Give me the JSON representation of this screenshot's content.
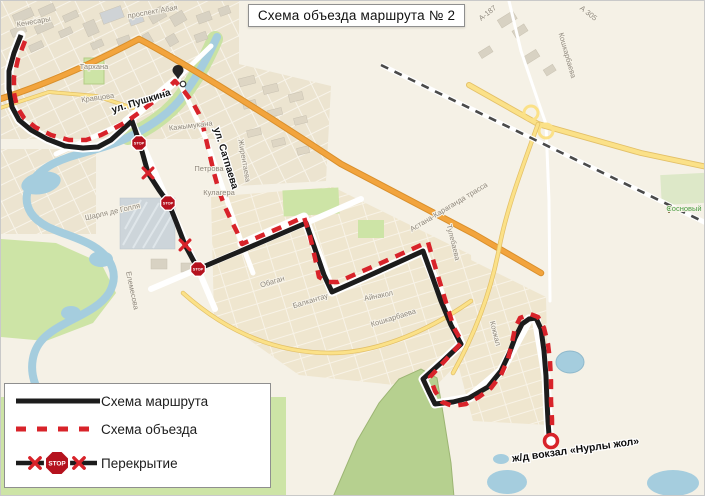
{
  "title": "Схема объезда маршрута № 2",
  "legend": {
    "items": [
      {
        "label": "Схема маршрута",
        "type": "route-solid"
      },
      {
        "label": "Схема объезда",
        "type": "route-dashed"
      },
      {
        "label": "Перекрытие",
        "type": "closure"
      }
    ]
  },
  "map": {
    "stop_sign_text": "STOP",
    "street_labels": [
      {
        "text": "Кенесары",
        "x": 33,
        "y": 23,
        "rot": -10,
        "kind": "minor"
      },
      {
        "text": "проспект Абая",
        "x": 152,
        "y": 13,
        "rot": -10,
        "kind": "minor"
      },
      {
        "text": "Тархана",
        "x": 93,
        "y": 68,
        "rot": 0,
        "kind": "minor"
      },
      {
        "text": "Кравцова",
        "x": 97,
        "y": 99,
        "rot": -8,
        "kind": "minor"
      },
      {
        "text": "Кажымукана",
        "x": 190,
        "y": 127,
        "rot": -7,
        "kind": "minor"
      },
      {
        "text": "Петрова",
        "x": 208,
        "y": 170,
        "rot": 0,
        "kind": "minor"
      },
      {
        "text": "Кулагера",
        "x": 218,
        "y": 194,
        "rot": 0,
        "kind": "minor"
      },
      {
        "text": "Жирентаева",
        "x": 241,
        "y": 160,
        "rot": 80,
        "kind": "minor"
      },
      {
        "text": "Шарля де Голля",
        "x": 112,
        "y": 213,
        "rot": -13,
        "kind": "minor"
      },
      {
        "text": "Елемесова",
        "x": 129,
        "y": 290,
        "rot": 78,
        "kind": "minor"
      },
      {
        "text": "Обаган",
        "x": 272,
        "y": 283,
        "rot": -17,
        "kind": "minor"
      },
      {
        "text": "Балкантау",
        "x": 310,
        "y": 302,
        "rot": -17,
        "kind": "minor"
      },
      {
        "text": "Айнакол",
        "x": 378,
        "y": 297,
        "rot": -12,
        "kind": "minor"
      },
      {
        "text": "Кошкарбаева",
        "x": 393,
        "y": 319,
        "rot": -17,
        "kind": "minor"
      },
      {
        "text": "Кошкарбаева",
        "x": 564,
        "y": 55,
        "rot": 74,
        "kind": "minor"
      },
      {
        "text": "Тулебаева",
        "x": 450,
        "y": 242,
        "rot": 76,
        "kind": "minor"
      },
      {
        "text": "Кокжал",
        "x": 492,
        "y": 333,
        "rot": 76,
        "kind": "minor"
      },
      {
        "text": "Астана-Караганда трасса",
        "x": 449,
        "y": 208,
        "rot": -31,
        "kind": "minor"
      },
      {
        "text": "А 305",
        "x": 586,
        "y": 14,
        "rot": 38,
        "kind": "minor"
      },
      {
        "text": "А-187",
        "x": 488,
        "y": 14,
        "rot": -38,
        "kind": "minor"
      },
      {
        "text": "Сосновый",
        "x": 683,
        "y": 210,
        "rot": 0,
        "kind": "poi"
      },
      {
        "text": "ул. Пушкина",
        "x": 141,
        "y": 103,
        "rot": -17,
        "kind": "major"
      },
      {
        "text": "ул. Сатпаева",
        "x": 222,
        "y": 158,
        "rot": 73,
        "kind": "major"
      },
      {
        "text": "ж/д вокзал «Нурлы жол»",
        "x": 575,
        "y": 452,
        "rot": -8,
        "kind": "station"
      }
    ]
  },
  "colors": {
    "route_black": "#1c1c1c",
    "route_red": "#d8232a",
    "stop_red": "#b5121e",
    "water_blue": "#a5cdde",
    "park_green": "#cde4a6",
    "road_orange": "#f2a43d",
    "road_yellow": "#fbe188",
    "map_background": "#f5f1e6"
  }
}
